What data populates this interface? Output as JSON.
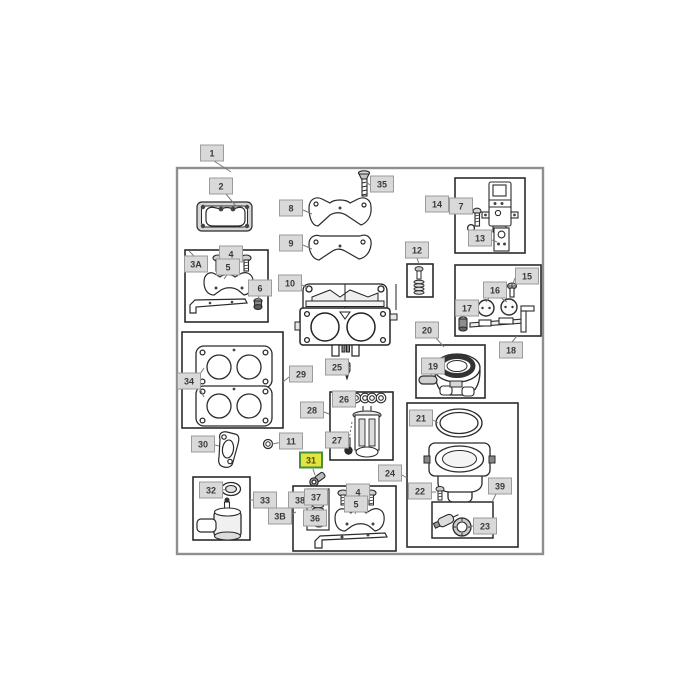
{
  "diagram": {
    "type": "exploded-parts-diagram",
    "description": "Carburetor assembly parts diagram with numbered callouts",
    "colors": {
      "label_bg": "#d9d9d9",
      "label_border": "#9b9b9b",
      "label_text": "#3a3a3a",
      "highlight_bg": "#e4e43e",
      "highlight_border": "#44903c",
      "highlight_text": "#4c4c10",
      "leader_line": "#7a7a7a",
      "frame_border": "#8f8f8f"
    },
    "callouts": [
      {
        "id": "1",
        "label": "1",
        "x": 212,
        "y": 153,
        "highlighted": false,
        "leaders": [
          [
            214,
            161,
            231,
            172
          ]
        ]
      },
      {
        "id": "2",
        "label": "2",
        "x": 221,
        "y": 186,
        "highlighted": false,
        "leaders": [
          [
            226,
            194,
            236,
            206
          ]
        ]
      },
      {
        "id": "35",
        "label": "35",
        "x": 382,
        "y": 184,
        "highlighted": false,
        "leaders": [
          [
            370,
            185,
            366,
            182
          ]
        ]
      },
      {
        "id": "8",
        "label": "8",
        "x": 291,
        "y": 208,
        "highlighted": false,
        "leaders": [
          [
            303,
            210,
            312,
            214
          ]
        ]
      },
      {
        "id": "9",
        "label": "9",
        "x": 291,
        "y": 243,
        "highlighted": false,
        "leaders": [
          [
            303,
            245,
            312,
            249
          ]
        ]
      },
      {
        "id": "14",
        "label": "14",
        "x": 437,
        "y": 204,
        "highlighted": false,
        "leaders": [
          [
            449,
            207,
            457,
            214
          ]
        ]
      },
      {
        "id": "7",
        "label": "7",
        "x": 461,
        "y": 206,
        "highlighted": false,
        "leaders": [
          [
            465,
            214,
            473,
            213
          ]
        ]
      },
      {
        "id": "13",
        "label": "13",
        "x": 480,
        "y": 238,
        "highlighted": false,
        "leaders": [
          [
            492,
            240,
            497,
            242
          ]
        ]
      },
      {
        "id": "3A",
        "label": "3A",
        "x": 196,
        "y": 264,
        "highlighted": false,
        "leaders": [
          [
            194,
            256,
            189,
            251
          ]
        ]
      },
      {
        "id": "4-top",
        "label": "4",
        "x": 231,
        "y": 254,
        "highlighted": false,
        "leaders": [
          [
            222,
            259,
            218,
            261
          ],
          [
            240,
            259,
            245,
            261
          ]
        ]
      },
      {
        "id": "5-top",
        "label": "5",
        "x": 228,
        "y": 267,
        "highlighted": false,
        "leaders": [
          [
            227,
            275,
            224,
            279
          ]
        ]
      },
      {
        "id": "6",
        "label": "6",
        "x": 260,
        "y": 288,
        "highlighted": false,
        "leaders": [
          [
            259,
            296,
            258,
            300
          ]
        ]
      },
      {
        "id": "10",
        "label": "10",
        "x": 290,
        "y": 283,
        "highlighted": false,
        "leaders": [
          [
            302,
            285,
            308,
            288
          ]
        ]
      },
      {
        "id": "12",
        "label": "12",
        "x": 417,
        "y": 250,
        "highlighted": false,
        "leaders": [
          [
            417,
            258,
            419,
            264
          ]
        ]
      },
      {
        "id": "15",
        "label": "15",
        "x": 527,
        "y": 276,
        "highlighted": false,
        "leaders": [
          [
            515,
            278,
            513,
            284
          ]
        ]
      },
      {
        "id": "16",
        "label": "16",
        "x": 495,
        "y": 290,
        "highlighted": false,
        "leaders": [
          [
            489,
            298,
            486,
            302
          ],
          [
            501,
            298,
            507,
            302
          ]
        ]
      },
      {
        "id": "17",
        "label": "17",
        "x": 467,
        "y": 308,
        "highlighted": false,
        "leaders": [
          [
            464,
            316,
            463,
            319
          ]
        ]
      },
      {
        "id": "18",
        "label": "18",
        "x": 511,
        "y": 350,
        "highlighted": false,
        "leaders": [
          [
            512,
            342,
            517,
            336
          ]
        ]
      },
      {
        "id": "25",
        "label": "25",
        "x": 337,
        "y": 367,
        "highlighted": false,
        "leaders": [
          [
            349,
            368,
            345,
            369
          ]
        ]
      },
      {
        "id": "29",
        "label": "29",
        "x": 301,
        "y": 374,
        "highlighted": false,
        "leaders": [
          [
            289,
            377,
            283,
            382
          ]
        ]
      },
      {
        "id": "34",
        "label": "34",
        "x": 189,
        "y": 381,
        "highlighted": false,
        "leaders": [
          [
            198,
            377,
            204,
            368
          ],
          [
            198,
            385,
            204,
            397
          ]
        ]
      },
      {
        "id": "28",
        "label": "28",
        "x": 312,
        "y": 410,
        "highlighted": false,
        "leaders": [
          [
            324,
            412,
            329,
            414
          ]
        ]
      },
      {
        "id": "26",
        "label": "26",
        "x": 344,
        "y": 399,
        "highlighted": false,
        "leaders": [
          [
            356,
            400,
            359,
            399
          ]
        ]
      },
      {
        "id": "27",
        "label": "27",
        "x": 337,
        "y": 440,
        "highlighted": false,
        "leaders": [
          [
            349,
            444,
            348,
            447
          ]
        ]
      },
      {
        "id": "31",
        "label": "31",
        "x": 311,
        "y": 460,
        "highlighted": true,
        "leaders": [
          [
            313,
            469,
            315,
            475
          ]
        ]
      },
      {
        "id": "24",
        "label": "24",
        "x": 390,
        "y": 473,
        "highlighted": false,
        "leaders": [
          [
            402,
            475,
            407,
            478
          ]
        ]
      },
      {
        "id": "22",
        "label": "22",
        "x": 420,
        "y": 491,
        "highlighted": false,
        "leaders": [
          [
            432,
            492,
            436,
            492
          ]
        ]
      },
      {
        "id": "21",
        "label": "21",
        "x": 421,
        "y": 418,
        "highlighted": false,
        "leaders": [
          [
            433,
            420,
            438,
            423
          ]
        ]
      },
      {
        "id": "39",
        "label": "39",
        "x": 500,
        "y": 486,
        "highlighted": false,
        "leaders": [
          [
            496,
            494,
            492,
            502
          ]
        ]
      },
      {
        "id": "23",
        "label": "23",
        "x": 485,
        "y": 526,
        "highlighted": false,
        "leaders": [
          [
            473,
            526,
            470,
            527
          ]
        ]
      },
      {
        "id": "20",
        "label": "20",
        "x": 427,
        "y": 330,
        "highlighted": false,
        "leaders": [
          [
            436,
            338,
            444,
            347
          ]
        ]
      },
      {
        "id": "19",
        "label": "19",
        "x": 433,
        "y": 366,
        "highlighted": false,
        "leaders": [
          [
            432,
            373,
            430,
            377
          ]
        ]
      },
      {
        "id": "30",
        "label": "30",
        "x": 203,
        "y": 444,
        "highlighted": false,
        "leaders": [
          [
            215,
            445,
            219,
            446
          ]
        ]
      },
      {
        "id": "11",
        "label": "11",
        "x": 291,
        "y": 441,
        "highlighted": false,
        "leaders": [
          [
            283,
            442,
            272,
            444
          ]
        ]
      },
      {
        "id": "32",
        "label": "32",
        "x": 211,
        "y": 490,
        "highlighted": false,
        "leaders": [
          [
            223,
            490,
            227,
            489
          ]
        ]
      },
      {
        "id": "33",
        "label": "33",
        "x": 265,
        "y": 500,
        "highlighted": false,
        "leaders": [
          [
            253,
            500,
            250,
            500
          ]
        ]
      },
      {
        "id": "3B",
        "label": "3B",
        "x": 280,
        "y": 516,
        "highlighted": false,
        "leaders": [
          [
            292,
            514,
            296,
            512
          ]
        ]
      },
      {
        "id": "38",
        "label": "38",
        "x": 300,
        "y": 500,
        "highlighted": false,
        "leaders": []
      },
      {
        "id": "37",
        "label": "37",
        "x": 316,
        "y": 497,
        "highlighted": false,
        "leaders": [
          [
            320,
            505,
            319,
            502
          ]
        ]
      },
      {
        "id": "36",
        "label": "36",
        "x": 315,
        "y": 518,
        "highlighted": false,
        "leaders": [
          [
            323,
            517,
            318,
            516
          ]
        ]
      },
      {
        "id": "4-bottom",
        "label": "4",
        "x": 358,
        "y": 492,
        "highlighted": false,
        "leaders": [
          [
            350,
            497,
            346,
            494
          ],
          [
            366,
            497,
            370,
            494
          ]
        ]
      },
      {
        "id": "5-bottom",
        "label": "5",
        "x": 356,
        "y": 504,
        "highlighted": false,
        "leaders": [
          [
            356,
            511,
            355,
            514
          ]
        ]
      }
    ]
  }
}
